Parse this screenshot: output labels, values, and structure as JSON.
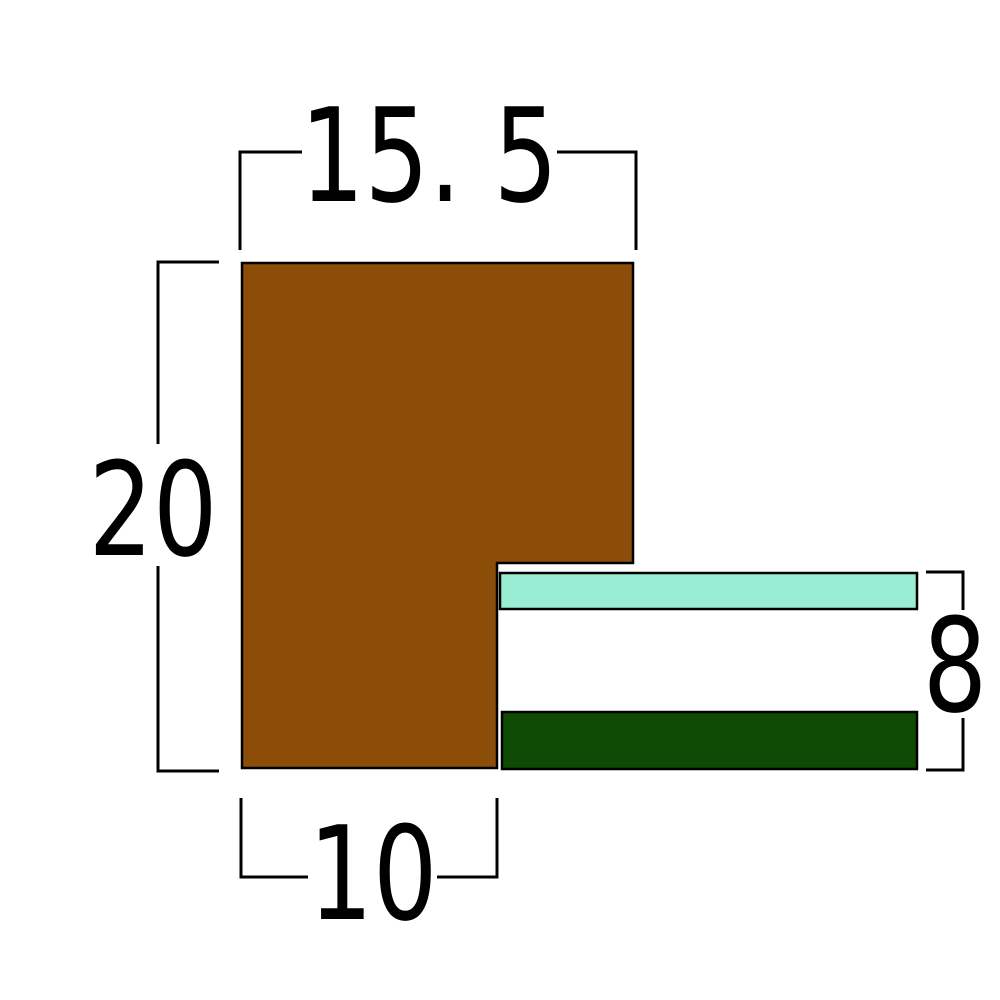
{
  "diagram": {
    "background_color": "#ffffff",
    "dimension_labels": {
      "top_width": "15. 5",
      "left_height": "20",
      "bottom_width": "10",
      "right_height": "8"
    },
    "colors": {
      "profile_fill": "#8B4D07",
      "teal_strip_fill": "#99EDD2",
      "green_strip_fill": "#0E4A03",
      "outline": "#000000",
      "dimension_line": "#000000",
      "label_text": "#000000"
    }
  }
}
